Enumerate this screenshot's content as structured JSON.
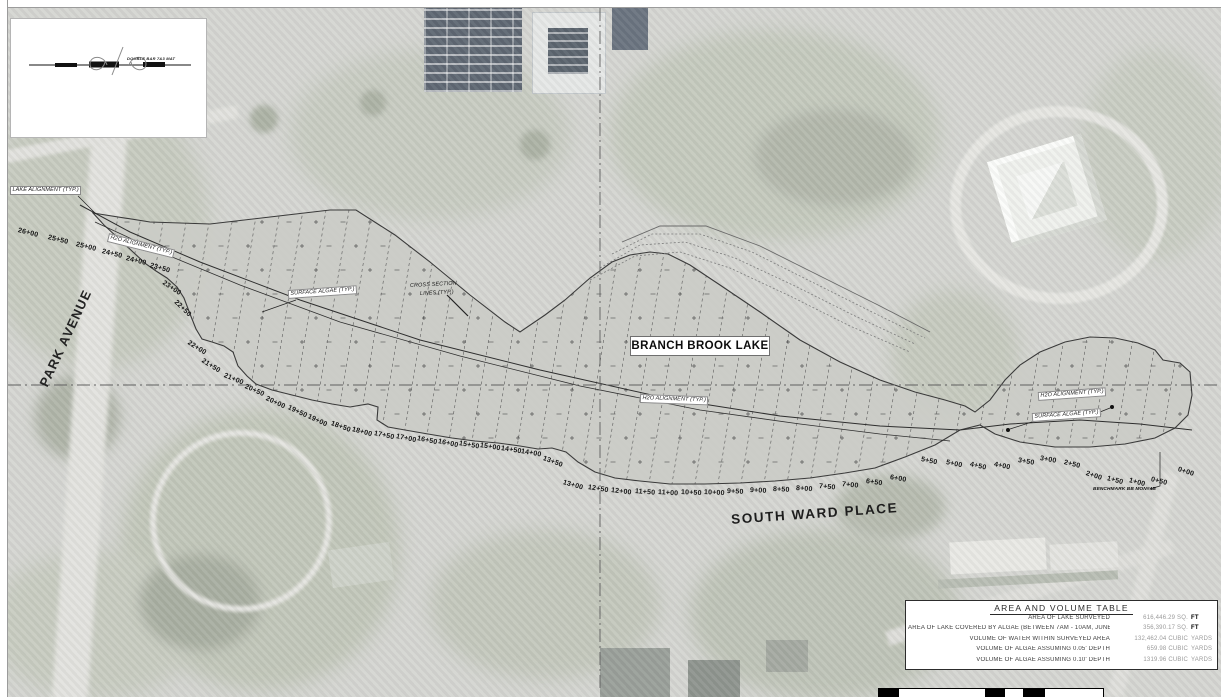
{
  "legend": {
    "text": "DOUBLE BAR 7&3 MAT"
  },
  "map": {
    "lake_name": "BRANCH BROOK LAKE",
    "streets": [
      {
        "name": "PARK AVENUE"
      },
      {
        "name": "SOUTH WARD PLACE"
      }
    ],
    "benchmark": "BENCHMARK BB MON#4B",
    "annotations": [
      {
        "text": "LAKE ALIGNMENT (TYP.)",
        "x": 10,
        "y": 186,
        "rot": 0,
        "style": "boxed"
      },
      {
        "text": "H2O ALIGNMENT (TYP.)",
        "x": 108,
        "y": 233,
        "rot": 14,
        "style": "boxed"
      },
      {
        "text": "SURFACE ALGAE (TYP.)",
        "x": 288,
        "y": 290,
        "rot": -4,
        "style": "boxed"
      },
      {
        "text": "CROSS SECTION",
        "x": 410,
        "y": 283,
        "rot": -3,
        "style": "plain"
      },
      {
        "text": "LINES (TYP.)",
        "x": 420,
        "y": 291,
        "rot": -3,
        "style": "plain"
      },
      {
        "text": "H2O ALIGNMENT (TYP.)",
        "x": 640,
        "y": 394,
        "rot": 2,
        "style": "boxed"
      },
      {
        "text": "H2O ALIGNMENT (TYP.)",
        "x": 1038,
        "y": 392,
        "rot": -4,
        "style": "boxed"
      },
      {
        "text": "SURFACE ALGAE (TYP.)",
        "x": 1032,
        "y": 413,
        "rot": -4,
        "style": "boxed"
      }
    ],
    "stations": [
      {
        "label": "26+00",
        "x": 18,
        "y": 227,
        "rot": 14
      },
      {
        "label": "25+50",
        "x": 48,
        "y": 234,
        "rot": 14
      },
      {
        "label": "25+00",
        "x": 76,
        "y": 241,
        "rot": 14
      },
      {
        "label": "24+50",
        "x": 102,
        "y": 248,
        "rot": 14
      },
      {
        "label": "24+00",
        "x": 126,
        "y": 255,
        "rot": 14
      },
      {
        "label": "23+50",
        "x": 150,
        "y": 262,
        "rot": 16
      },
      {
        "label": "23+00",
        "x": 163,
        "y": 279,
        "rot": 34
      },
      {
        "label": "22+50",
        "x": 175,
        "y": 298,
        "rot": 44
      },
      {
        "label": "22+00",
        "x": 188,
        "y": 339,
        "rot": 32
      },
      {
        "label": "21+50",
        "x": 202,
        "y": 357,
        "rot": 32
      },
      {
        "label": "21+00",
        "x": 224,
        "y": 372,
        "rot": 22
      },
      {
        "label": "20+50",
        "x": 245,
        "y": 383,
        "rot": 24
      },
      {
        "label": "20+00",
        "x": 266,
        "y": 395,
        "rot": 25
      },
      {
        "label": "19+50",
        "x": 288,
        "y": 404,
        "rot": 25
      },
      {
        "label": "19+00",
        "x": 308,
        "y": 413,
        "rot": 25
      },
      {
        "label": "18+50",
        "x": 331,
        "y": 420,
        "rot": 20
      },
      {
        "label": "18+00",
        "x": 352,
        "y": 426,
        "rot": 15
      },
      {
        "label": "17+50",
        "x": 374,
        "y": 430,
        "rot": 12
      },
      {
        "label": "17+00",
        "x": 396,
        "y": 433,
        "rot": 12
      },
      {
        "label": "16+50",
        "x": 417,
        "y": 435,
        "rot": 12
      },
      {
        "label": "16+00",
        "x": 438,
        "y": 438,
        "rot": 12
      },
      {
        "label": "15+50",
        "x": 459,
        "y": 440,
        "rot": 10
      },
      {
        "label": "15+00",
        "x": 480,
        "y": 442,
        "rot": 9
      },
      {
        "label": "14+50",
        "x": 501,
        "y": 445,
        "rot": 9
      },
      {
        "label": "14+00",
        "x": 521,
        "y": 448,
        "rot": 10
      },
      {
        "label": "13+50",
        "x": 543,
        "y": 455,
        "rot": 20
      },
      {
        "label": "13+00",
        "x": 563,
        "y": 479,
        "rot": 16
      },
      {
        "label": "12+50",
        "x": 588,
        "y": 484,
        "rot": 9
      },
      {
        "label": "12+00",
        "x": 611,
        "y": 487,
        "rot": 7
      },
      {
        "label": "11+50",
        "x": 635,
        "y": 488,
        "rot": 5
      },
      {
        "label": "11+00",
        "x": 658,
        "y": 489,
        "rot": 4
      },
      {
        "label": "10+50",
        "x": 681,
        "y": 489,
        "rot": 3
      },
      {
        "label": "10+00",
        "x": 704,
        "y": 489,
        "rot": 3
      },
      {
        "label": "9+50",
        "x": 727,
        "y": 488,
        "rot": 3
      },
      {
        "label": "9+00",
        "x": 750,
        "y": 487,
        "rot": 3
      },
      {
        "label": "8+50",
        "x": 773,
        "y": 486,
        "rot": 3
      },
      {
        "label": "8+00",
        "x": 796,
        "y": 485,
        "rot": 4
      },
      {
        "label": "7+50",
        "x": 819,
        "y": 483,
        "rot": 5
      },
      {
        "label": "7+00",
        "x": 842,
        "y": 481,
        "rot": 6
      },
      {
        "label": "6+50",
        "x": 866,
        "y": 478,
        "rot": 8
      },
      {
        "label": "6+00",
        "x": 890,
        "y": 474,
        "rot": 10
      },
      {
        "label": "5+50",
        "x": 921,
        "y": 456,
        "rot": 12
      },
      {
        "label": "5+00",
        "x": 946,
        "y": 459,
        "rot": 12
      },
      {
        "label": "4+50",
        "x": 970,
        "y": 461,
        "rot": 13
      },
      {
        "label": "4+00",
        "x": 994,
        "y": 461,
        "rot": 12
      },
      {
        "label": "3+50",
        "x": 1018,
        "y": 457,
        "rot": 10
      },
      {
        "label": "3+00",
        "x": 1040,
        "y": 455,
        "rot": 10
      },
      {
        "label": "2+50",
        "x": 1064,
        "y": 459,
        "rot": 14
      },
      {
        "label": "2+00",
        "x": 1086,
        "y": 470,
        "rot": 18
      },
      {
        "label": "1+50",
        "x": 1107,
        "y": 475,
        "rot": 15
      },
      {
        "label": "1+00",
        "x": 1129,
        "y": 477,
        "rot": 15
      },
      {
        "label": "0+50",
        "x": 1151,
        "y": 476,
        "rot": 14
      },
      {
        "label": "0+00",
        "x": 1178,
        "y": 466,
        "rot": 18
      }
    ]
  },
  "area_volume_table": {
    "title": "AREA AND VOLUME TABLE",
    "rows": [
      {
        "label": "AREA OF LAKE SURVEYED",
        "value": "616,446.29 SQ.",
        "unit": "FT",
        "unit_strong": true
      },
      {
        "label": "AREA OF LAKE COVERED BY ALGAE (BETWEEN 7AM - 10AM, JUNE 29, 2019)",
        "value": "356,390.17 SQ.",
        "unit": "FT",
        "unit_strong": true
      },
      {
        "label": "VOLUME OF WATER WITHIN SURVEYED AREA",
        "value": "132,462.04 CUBIC",
        "unit": "YARDS",
        "unit_strong": false
      },
      {
        "label": "VOLUME OF ALGAE ASSUMING 0.05' DEPTH",
        "value": "659.98 CUBIC",
        "unit": "YARDS",
        "unit_strong": false
      },
      {
        "label": "VOLUME OF ALGAE ASSUMING 0.10' DEPTH",
        "value": "1319.96 CUBIC",
        "unit": "YARDS",
        "unit_strong": false
      }
    ]
  },
  "colors": {
    "photo_base": "#d5d6d2",
    "photo_green": "#c3c8bb",
    "lake_fill": "#cbccc7",
    "linework": "#3a3a3a",
    "table_value": "#9a9a9a"
  }
}
